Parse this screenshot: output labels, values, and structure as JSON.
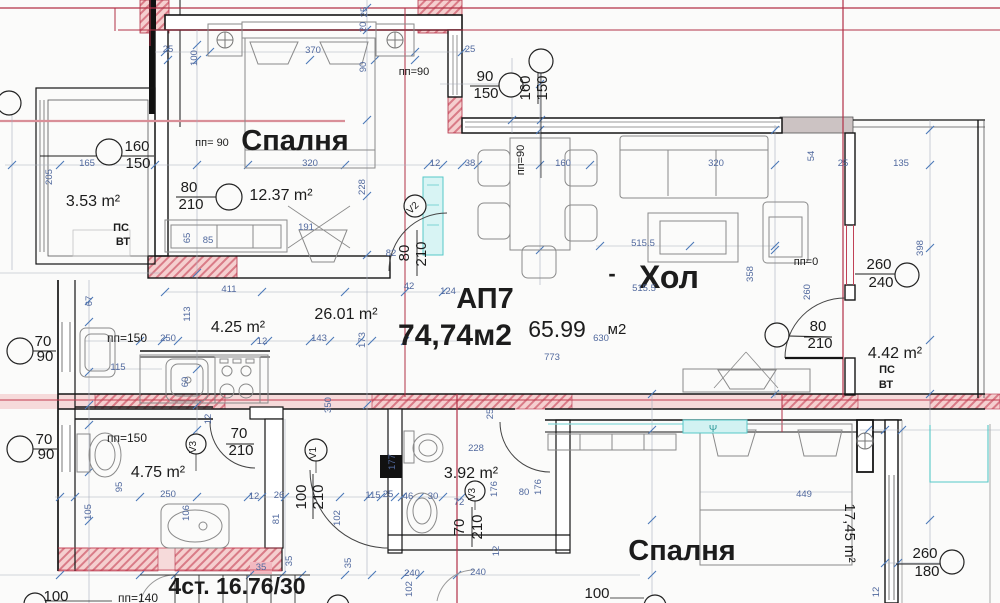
{
  "colors": {
    "ink": "#1c1c1c",
    "dim": "#51699e",
    "dimg": "#7d8595",
    "red": "#b23046",
    "cyanink": "#2f9b9b"
  },
  "apartment": {
    "id": "АП7",
    "total_area": "74,74м2",
    "net_area": "65.99 м2",
    "stairs_note": "4ст. 16.76/30"
  },
  "rooms": [
    {
      "name": "Спалня",
      "area": "12.37 m²"
    },
    {
      "name": "Хол",
      "area": "65.99 м2"
    },
    {
      "name": "Спалня",
      "area": "17,45 m²"
    },
    {
      "name": "",
      "area": "3.53 m²"
    },
    {
      "name": "",
      "area": "4.25 m²"
    },
    {
      "name": "",
      "area": "26.01 m²"
    },
    {
      "name": "",
      "area": "4.75 m²"
    },
    {
      "name": "",
      "area": "3.92 m²"
    },
    {
      "name": "",
      "area": "4.42 m²"
    }
  ],
  "labels": [
    {
      "t": "Спалня",
      "x": 295,
      "y": 150,
      "s": 29,
      "c": "ink",
      "b": 1,
      "n": "room-label-bedroom-top"
    },
    {
      "t": "Хол",
      "x": 669,
      "y": 288,
      "s": 32,
      "c": "ink",
      "b": 1,
      "n": "room-label-living"
    },
    {
      "t": "-",
      "x": 612,
      "y": 281,
      "s": 22,
      "c": "ink",
      "b": 1,
      "n": "dash-before-living"
    },
    {
      "t": "Спалня",
      "x": 682,
      "y": 560,
      "s": 29,
      "c": "ink",
      "b": 1,
      "n": "room-label-bedroom-bottom"
    },
    {
      "t": "АП7",
      "x": 485,
      "y": 308,
      "s": 29,
      "c": "ink",
      "b": 1,
      "n": "apartment-id"
    },
    {
      "t": "74,74м2",
      "x": 455,
      "y": 345,
      "s": 30,
      "c": "ink",
      "b": 1,
      "n": "apartment-total-area"
    },
    {
      "t": "65.99",
      "x": 557,
      "y": 337,
      "s": 23,
      "c": "ink",
      "n": "net-area-value"
    },
    {
      "t": "м2",
      "x": 617,
      "y": 334,
      "s": 15,
      "c": "ink",
      "n": "net-area-unit"
    },
    {
      "t": "4ст. 16.76/30",
      "x": 237,
      "y": 594,
      "s": 23,
      "c": "ink",
      "b": 1,
      "n": "stairs-label"
    },
    {
      "t": "3.53 m²",
      "x": 93,
      "y": 206,
      "s": 16,
      "c": "ink",
      "n": "area-balcony-left"
    },
    {
      "t": "12.37 m²",
      "x": 281,
      "y": 200,
      "s": 16,
      "c": "ink",
      "n": "area-bedroom-top"
    },
    {
      "t": "4.25 m²",
      "x": 238,
      "y": 332,
      "s": 16,
      "c": "ink",
      "n": "area-kitchen"
    },
    {
      "t": "26.01 m²",
      "x": 346,
      "y": 319,
      "s": 16,
      "c": "ink",
      "n": "area-corridor"
    },
    {
      "t": "4.75 m²",
      "x": 158,
      "y": 477,
      "s": 16,
      "c": "ink",
      "n": "area-bathroom"
    },
    {
      "t": "3.92 m²",
      "x": 471,
      "y": 478,
      "s": 16,
      "c": "ink",
      "n": "area-wc"
    },
    {
      "t": "4.42 m²",
      "x": 895,
      "y": 358,
      "s": 16,
      "c": "ink",
      "n": "area-balcony-right"
    },
    {
      "t": "17,45 m²",
      "x": 845,
      "y": 533,
      "s": 15,
      "r": 90,
      "c": "ink",
      "n": "area-bedroom-bottom"
    },
    {
      "t": "ПС",
      "x": 121,
      "y": 231,
      "s": 11,
      "c": "ink",
      "b": 1
    },
    {
      "t": "ВТ",
      "x": 123,
      "y": 245,
      "s": 11,
      "c": "ink",
      "b": 1
    },
    {
      "t": "ПС",
      "x": 887,
      "y": 373,
      "s": 11,
      "c": "ink",
      "b": 1
    },
    {
      "t": "ВТ",
      "x": 886,
      "y": 388,
      "s": 11,
      "c": "ink",
      "b": 1
    },
    {
      "t": "160",
      "x": 137,
      "y": 151,
      "s": 15,
      "c": "ink"
    },
    {
      "t": "150",
      "x": 138,
      "y": 168,
      "s": 15,
      "c": "ink"
    },
    {
      "t": "80",
      "x": 189,
      "y": 192,
      "s": 15,
      "c": "ink"
    },
    {
      "t": "210",
      "x": 191,
      "y": 209,
      "s": 15,
      "c": "ink"
    },
    {
      "t": "пп= 90",
      "x": 212,
      "y": 146,
      "s": 11,
      "c": "ink"
    },
    {
      "t": "90",
      "x": 485,
      "y": 81,
      "s": 15,
      "c": "ink"
    },
    {
      "t": "150",
      "x": 486,
      "y": 98,
      "s": 15,
      "c": "ink"
    },
    {
      "t": "160",
      "x": 530,
      "y": 88,
      "s": 15,
      "r": -90,
      "c": "ink"
    },
    {
      "t": "150",
      "x": 547,
      "y": 88,
      "s": 15,
      "r": -90,
      "c": "ink"
    },
    {
      "t": "пп=90",
      "x": 414,
      "y": 75,
      "s": 11,
      "c": "ink"
    },
    {
      "t": "пп=90",
      "x": 524,
      "y": 160,
      "s": 11,
      "r": -90,
      "c": "ink"
    },
    {
      "t": "80",
      "x": 409,
      "y": 253,
      "s": 15,
      "r": -90,
      "c": "ink"
    },
    {
      "t": "210",
      "x": 426,
      "y": 254,
      "s": 15,
      "r": -90,
      "c": "ink"
    },
    {
      "t": "V2",
      "x": 415,
      "y": 210,
      "s": 10,
      "r": -45,
      "c": "ink"
    },
    {
      "t": "пп=0",
      "x": 806,
      "y": 265,
      "s": 11,
      "c": "ink"
    },
    {
      "t": "260",
      "x": 879,
      "y": 269,
      "s": 15,
      "c": "ink"
    },
    {
      "t": "240",
      "x": 881,
      "y": 287,
      "s": 15,
      "c": "ink"
    },
    {
      "t": "80",
      "x": 818,
      "y": 331,
      "s": 15,
      "c": "ink"
    },
    {
      "t": "210",
      "x": 820,
      "y": 348,
      "s": 15,
      "c": "ink"
    },
    {
      "t": "пп=150",
      "x": 127,
      "y": 342,
      "s": 12,
      "c": "ink"
    },
    {
      "t": "пп=150",
      "x": 127,
      "y": 442,
      "s": 12,
      "c": "ink"
    },
    {
      "t": "70",
      "x": 43,
      "y": 346,
      "s": 15,
      "c": "ink"
    },
    {
      "t": "90",
      "x": 45,
      "y": 361,
      "s": 15,
      "c": "ink"
    },
    {
      "t": "70",
      "x": 44,
      "y": 444,
      "s": 15,
      "c": "ink"
    },
    {
      "t": "90",
      "x": 46,
      "y": 459,
      "s": 15,
      "c": "ink"
    },
    {
      "t": "V3",
      "x": 196,
      "y": 447,
      "s": 10,
      "r": -90,
      "c": "ink"
    },
    {
      "t": "70",
      "x": 239,
      "y": 438,
      "s": 15,
      "c": "ink"
    },
    {
      "t": "210",
      "x": 241,
      "y": 455,
      "s": 15,
      "c": "ink"
    },
    {
      "t": "V1",
      "x": 316,
      "y": 453,
      "s": 10,
      "r": -90,
      "c": "ink"
    },
    {
      "t": "100",
      "x": 306,
      "y": 497,
      "s": 15,
      "r": -90,
      "c": "ink"
    },
    {
      "t": "210",
      "x": 323,
      "y": 497,
      "s": 15,
      "r": -90,
      "c": "ink"
    },
    {
      "t": "V3",
      "x": 475,
      "y": 494,
      "s": 10,
      "r": -90,
      "c": "ink"
    },
    {
      "t": "70",
      "x": 464,
      "y": 527,
      "s": 15,
      "r": -90,
      "c": "ink"
    },
    {
      "t": "210",
      "x": 482,
      "y": 527,
      "s": 15,
      "r": -90,
      "c": "ink"
    },
    {
      "t": "260",
      "x": 925,
      "y": 558,
      "s": 15,
      "c": "ink"
    },
    {
      "t": "180",
      "x": 927,
      "y": 576,
      "s": 15,
      "c": "ink"
    },
    {
      "t": "пп=140",
      "x": 138,
      "y": 602,
      "s": 12,
      "c": "ink"
    },
    {
      "t": "100",
      "x": 56,
      "y": 601,
      "s": 15,
      "c": "ink"
    },
    {
      "t": "100",
      "x": 597,
      "y": 598,
      "s": 15,
      "c": "ink"
    },
    {
      "t": "Ψ",
      "x": 713,
      "y": 432,
      "s": 10,
      "c": "cyanink",
      "n": "fan-symbol"
    },
    {
      "t": "370",
      "x": 313,
      "y": 53
    },
    {
      "t": "25",
      "x": 168,
      "y": 52
    },
    {
      "t": "100",
      "x": 197,
      "y": 58,
      "r": -90
    },
    {
      "t": "25",
      "x": 367,
      "y": 12,
      "r": -90
    },
    {
      "t": "20",
      "x": 366,
      "y": 27,
      "r": -90
    },
    {
      "t": "90",
      "x": 366,
      "y": 67,
      "r": -90
    },
    {
      "t": "25",
      "x": 470,
      "y": 52
    },
    {
      "t": "165",
      "x": 87,
      "y": 166
    },
    {
      "t": "205",
      "x": 52,
      "y": 177,
      "r": -90
    },
    {
      "t": "228",
      "x": 365,
      "y": 187,
      "r": -90
    },
    {
      "t": "320",
      "x": 310,
      "y": 166
    },
    {
      "t": "191",
      "x": 306,
      "y": 230
    },
    {
      "t": "85",
      "x": 208,
      "y": 243
    },
    {
      "t": "65",
      "x": 190,
      "y": 238,
      "r": -90
    },
    {
      "t": "82",
      "x": 391,
      "y": 256
    },
    {
      "t": "12",
      "x": 435,
      "y": 166
    },
    {
      "t": "38",
      "x": 470,
      "y": 166
    },
    {
      "t": "160",
      "x": 563,
      "y": 166
    },
    {
      "t": "515.5",
      "x": 643,
      "y": 246
    },
    {
      "t": "515.5",
      "x": 644,
      "y": 291
    },
    {
      "t": "358",
      "x": 753,
      "y": 274,
      "r": -90
    },
    {
      "t": "320",
      "x": 716,
      "y": 166
    },
    {
      "t": "54",
      "x": 814,
      "y": 156,
      "r": -90
    },
    {
      "t": "25",
      "x": 843,
      "y": 166
    },
    {
      "t": "135",
      "x": 901,
      "y": 166
    },
    {
      "t": "398",
      "x": 923,
      "y": 248,
      "r": -90
    },
    {
      "t": "260",
      "x": 810,
      "y": 292,
      "r": -90
    },
    {
      "t": "67",
      "x": 92,
      "y": 301,
      "r": -90
    },
    {
      "t": "411",
      "x": 229,
      "y": 292
    },
    {
      "t": "113",
      "x": 190,
      "y": 314,
      "r": -90
    },
    {
      "t": "250",
      "x": 168,
      "y": 341
    },
    {
      "t": "12",
      "x": 262,
      "y": 344
    },
    {
      "t": "143",
      "x": 319,
      "y": 341
    },
    {
      "t": "173",
      "x": 365,
      "y": 340,
      "r": -90
    },
    {
      "t": "42",
      "x": 409,
      "y": 289
    },
    {
      "t": "124",
      "x": 448,
      "y": 294
    },
    {
      "t": "773",
      "x": 552,
      "y": 360
    },
    {
      "t": "630",
      "x": 601,
      "y": 341
    },
    {
      "t": "115",
      "x": 118,
      "y": 370
    },
    {
      "t": "60",
      "x": 188,
      "y": 382,
      "r": -90
    },
    {
      "t": "12",
      "x": 211,
      "y": 419,
      "r": -90
    },
    {
      "t": "350",
      "x": 331,
      "y": 405,
      "r": -90
    },
    {
      "t": "177",
      "x": 395,
      "y": 462,
      "r": -90
    },
    {
      "t": "95",
      "x": 122,
      "y": 487,
      "r": -90
    },
    {
      "t": "105",
      "x": 91,
      "y": 512,
      "r": -90
    },
    {
      "t": "250",
      "x": 168,
      "y": 497
    },
    {
      "t": "106",
      "x": 189,
      "y": 513,
      "r": -90
    },
    {
      "t": "12",
      "x": 254,
      "y": 499
    },
    {
      "t": "26",
      "x": 279,
      "y": 498
    },
    {
      "t": "81",
      "x": 279,
      "y": 519,
      "r": -90
    },
    {
      "t": "102",
      "x": 340,
      "y": 518,
      "r": -90
    },
    {
      "t": "115",
      "x": 373,
      "y": 498
    },
    {
      "t": "25",
      "x": 388,
      "y": 497
    },
    {
      "t": "46",
      "x": 408,
      "y": 499
    },
    {
      "t": "30",
      "x": 433,
      "y": 499
    },
    {
      "t": "72",
      "x": 459,
      "y": 505
    },
    {
      "t": "228",
      "x": 476,
      "y": 451
    },
    {
      "t": "176",
      "x": 497,
      "y": 489,
      "r": -90
    },
    {
      "t": "176",
      "x": 541,
      "y": 487,
      "r": -90
    },
    {
      "t": "80",
      "x": 524,
      "y": 495
    },
    {
      "t": "25",
      "x": 493,
      "y": 414,
      "r": -90
    },
    {
      "t": "12",
      "x": 499,
      "y": 551,
      "r": -90
    },
    {
      "t": "240",
      "x": 478,
      "y": 575
    },
    {
      "t": "240",
      "x": 412,
      "y": 576
    },
    {
      "t": "102",
      "x": 412,
      "y": 589,
      "r": -90
    },
    {
      "t": "35",
      "x": 261,
      "y": 570
    },
    {
      "t": "35",
      "x": 292,
      "y": 561,
      "r": -90
    },
    {
      "t": "35",
      "x": 351,
      "y": 563,
      "r": -90
    },
    {
      "t": "449",
      "x": 804,
      "y": 497
    },
    {
      "t": "12",
      "x": 879,
      "y": 592,
      "r": -90
    }
  ]
}
